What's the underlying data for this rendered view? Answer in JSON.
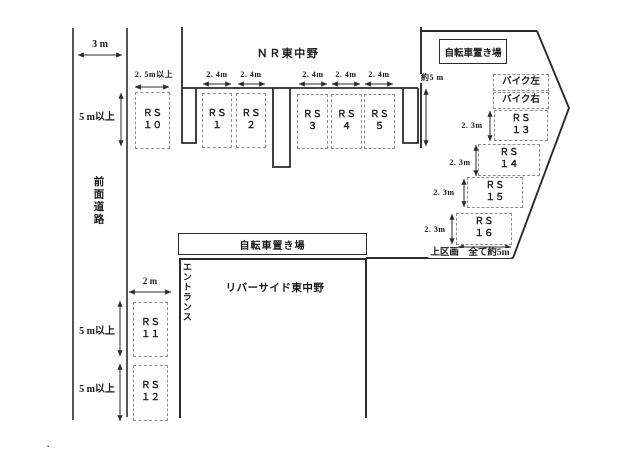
{
  "labels": {
    "nr_building": "ＮＲ東中野",
    "bicycle_parking_top": "自転車置き場",
    "bicycle_parking_mid": "自転車置き場",
    "riverside_building": "リバーサイド東中野",
    "entrance": "エントランス",
    "front_road": "前面道路",
    "upper_section_note": "上区画　全て約5m",
    "stray_dot": "."
  },
  "dimensions": {
    "road_width": "3 m",
    "front_clearance_top": "5 m以上",
    "rs10_width": "2. 5m以上",
    "approach_depth": "約5 m",
    "rs11_width": "2 m",
    "clearance_rs11": "5 m以上",
    "clearance_rs12": "5 m以上",
    "w24": [
      "2. 4m",
      "2. 4m",
      "2. 4m",
      "2. 4m",
      "2. 4m"
    ],
    "d23": [
      "2. 3m",
      "2. 3m",
      "2. 3m",
      "2. 3m"
    ]
  },
  "spots": {
    "rs1": "ＲＳ\n１",
    "rs2": "ＲＳ\n２",
    "rs3": "ＲＳ\n３",
    "rs4": "ＲＳ\n４",
    "rs5": "ＲＳ\n５",
    "rs10": "ＲＳ\n１０",
    "rs11": "ＲＳ\n１１",
    "rs12": "ＲＳ\n１２",
    "rs13": "ＲＳ\n１３",
    "rs14": "ＲＳ\n１４",
    "rs15": "ＲＳ\n１５",
    "rs16": "ＲＳ\n１６",
    "bike_left": "バイク左",
    "bike_right": "バイク右"
  },
  "colors": {
    "line": "#2b2b2b",
    "dashed_border": "#8f8f8f",
    "text": "#1a1a1a",
    "background": "#ffffff"
  }
}
